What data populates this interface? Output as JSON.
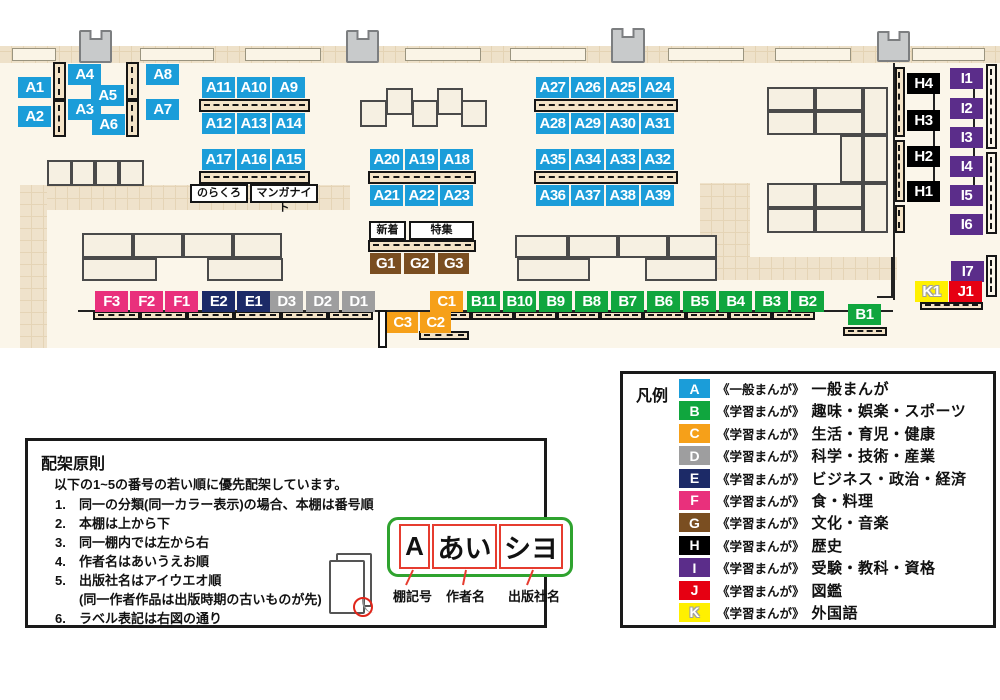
{
  "map": {
    "shelf_labels": [
      "A1",
      "A2",
      "A3",
      "A4",
      "A5",
      "A6",
      "A7",
      "A8",
      "A9",
      "A10",
      "A11",
      "A12",
      "A13",
      "A14",
      "A15",
      "A16",
      "A17",
      "A18",
      "A19",
      "A20",
      "A21",
      "A22",
      "A23",
      "A24",
      "A25",
      "A26",
      "A27",
      "A28",
      "A29",
      "A30",
      "A31",
      "A32",
      "A33",
      "A34",
      "A35",
      "A36",
      "A37",
      "A38",
      "A39",
      "B1",
      "B2",
      "B3",
      "B4",
      "B5",
      "B6",
      "B7",
      "B8",
      "B9",
      "B10",
      "B11",
      "C1",
      "C2",
      "C3",
      "D1",
      "D2",
      "D3",
      "E1",
      "E2",
      "F1",
      "F2",
      "F3",
      "G1",
      "G2",
      "G3",
      "H1",
      "H2",
      "H3",
      "H4",
      "I1",
      "I2",
      "I3",
      "I4",
      "I5",
      "I6",
      "I7",
      "J1",
      "K1"
    ],
    "annotations": [
      {
        "id": "norakuro",
        "text": "のらくろ"
      },
      {
        "id": "manga-night",
        "text": "マンガナイト"
      },
      {
        "id": "shinchaku",
        "text": "新着"
      },
      {
        "id": "tokushu",
        "text": "特集"
      }
    ]
  },
  "legend": {
    "title": "凡例",
    "items": [
      {
        "key": "A",
        "color": "#1B9DD9",
        "type": "《一般まんが》",
        "label": "一般まんが"
      },
      {
        "key": "B",
        "color": "#10A63E",
        "type": "《学習まんが》",
        "label": "趣味・娯楽・スポーツ"
      },
      {
        "key": "C",
        "color": "#F6A019",
        "type": "《学習まんが》",
        "label": "生活・育児・健康"
      },
      {
        "key": "D",
        "color": "#9E9E9F",
        "type": "《学習まんが》",
        "label": "科学・技術・産業"
      },
      {
        "key": "E",
        "color": "#1C2A67",
        "type": "《学習まんが》",
        "label": "ビジネス・政治・経済"
      },
      {
        "key": "F",
        "color": "#E9307C",
        "type": "《学習まんが》",
        "label": "食・料理"
      },
      {
        "key": "G",
        "color": "#7A4E21",
        "type": "《学習まんが》",
        "label": "文化・音楽"
      },
      {
        "key": "H",
        "color": "#000000",
        "type": "《学習まんが》",
        "label": "歴史"
      },
      {
        "key": "I",
        "color": "#5B2D8A",
        "type": "《学習まんが》",
        "label": "受験・教科・資格"
      },
      {
        "key": "J",
        "color": "#E60012",
        "type": "《学習まんが》",
        "label": "図鑑"
      },
      {
        "key": "K",
        "color": "#FFF000",
        "type": "《学習まんが》",
        "label": "外国語",
        "outline": true
      }
    ]
  },
  "principles": {
    "title": "配架原則",
    "intro": "以下の1~5の番号の若い順に優先配架しています。",
    "items": [
      {
        "num": "1.",
        "text": "同一の分類(同一カラー表示)の場合、本棚は番号順",
        "indent": false
      },
      {
        "num": "2.",
        "text": "本棚は上から下",
        "indent": false
      },
      {
        "num": "3.",
        "text": "同一棚内では左から右",
        "indent": false
      },
      {
        "num": "4.",
        "text": "作者名はあいうえお順",
        "indent": false
      },
      {
        "num": "5.",
        "text": "出版社名はアイウエオ順",
        "indent": false
      },
      {
        "num": "",
        "text": "(同一作者作品は出版時期の古いものが先)",
        "indent": true
      },
      {
        "num": "6.",
        "text": "ラベル表記は右図の通り",
        "indent": false
      }
    ],
    "label_diagram": {
      "boxes": [
        {
          "text": "A"
        },
        {
          "text": "あい"
        },
        {
          "text": "シヨ"
        }
      ],
      "captions": [
        "棚記号",
        "作者名",
        "出版社名"
      ]
    }
  }
}
